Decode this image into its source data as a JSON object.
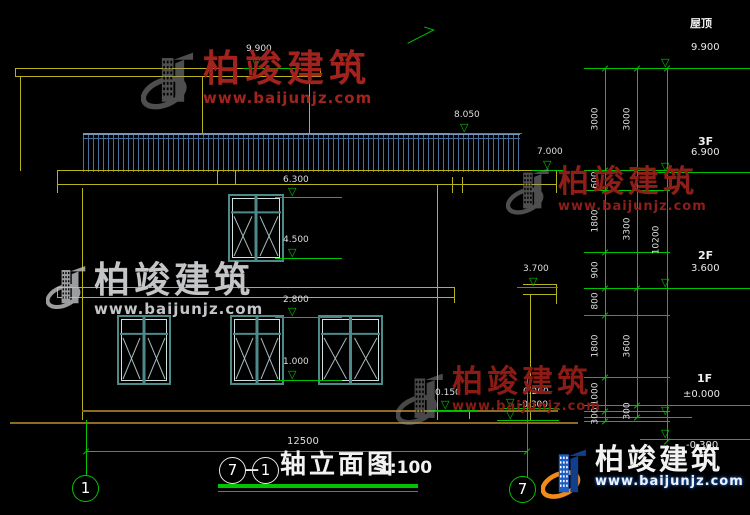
{
  "drawing": {
    "title": {
      "axis_from": "7",
      "dash": "—",
      "axis_to": "1",
      "name": "轴立面图",
      "scale": "1:100"
    },
    "axis_bubbles": {
      "left": "1",
      "right": "7"
    },
    "elevation_markers": [
      {
        "value": "9.900"
      },
      {
        "value": "8.050"
      },
      {
        "value": "7.000"
      },
      {
        "value": "6.300"
      },
      {
        "value": "4.500"
      },
      {
        "value": "3.700"
      },
      {
        "value": "2.800"
      },
      {
        "value": "1.000"
      },
      {
        "value": "0.150"
      },
      {
        "value": "0.200"
      },
      {
        "value": "-0.300"
      }
    ],
    "right_levels": [
      {
        "label": "屋顶",
        "value": "9.900"
      },
      {
        "label": "3F",
        "value": "6.900"
      },
      {
        "label": "2F",
        "value": "3.600"
      },
      {
        "label": "1F",
        "value": "±0.000"
      },
      {
        "label": "",
        "value": "-0.300"
      }
    ],
    "dim_chain_inner": [
      "3000",
      "600",
      "1800",
      "900",
      "800",
      "1800",
      "1000",
      "300"
    ],
    "dim_chain_mid": [
      "3000",
      "3300",
      "3600",
      "300"
    ],
    "dim_total_height": "10200",
    "dim_width": "12500"
  },
  "watermark": {
    "name": "柏竣建筑",
    "url": "www.baijunjz.com"
  },
  "colors": {
    "background": "#000000",
    "line_yellow": "#b9b31b",
    "dim_green": "#00c400",
    "ground_brown": "#8f6b22",
    "window_teal": "#4e8a8a",
    "window_light": "#cfe2e2",
    "railing_blue": "#46719c",
    "text_white": "#dedede",
    "watermark_red": "#9a211b",
    "watermark_gray": "#8f8f8f",
    "watermark_silver": "#c3c5c7",
    "logo_blue": "#1c5ec2",
    "logo_orange": "#ef8a1b"
  }
}
